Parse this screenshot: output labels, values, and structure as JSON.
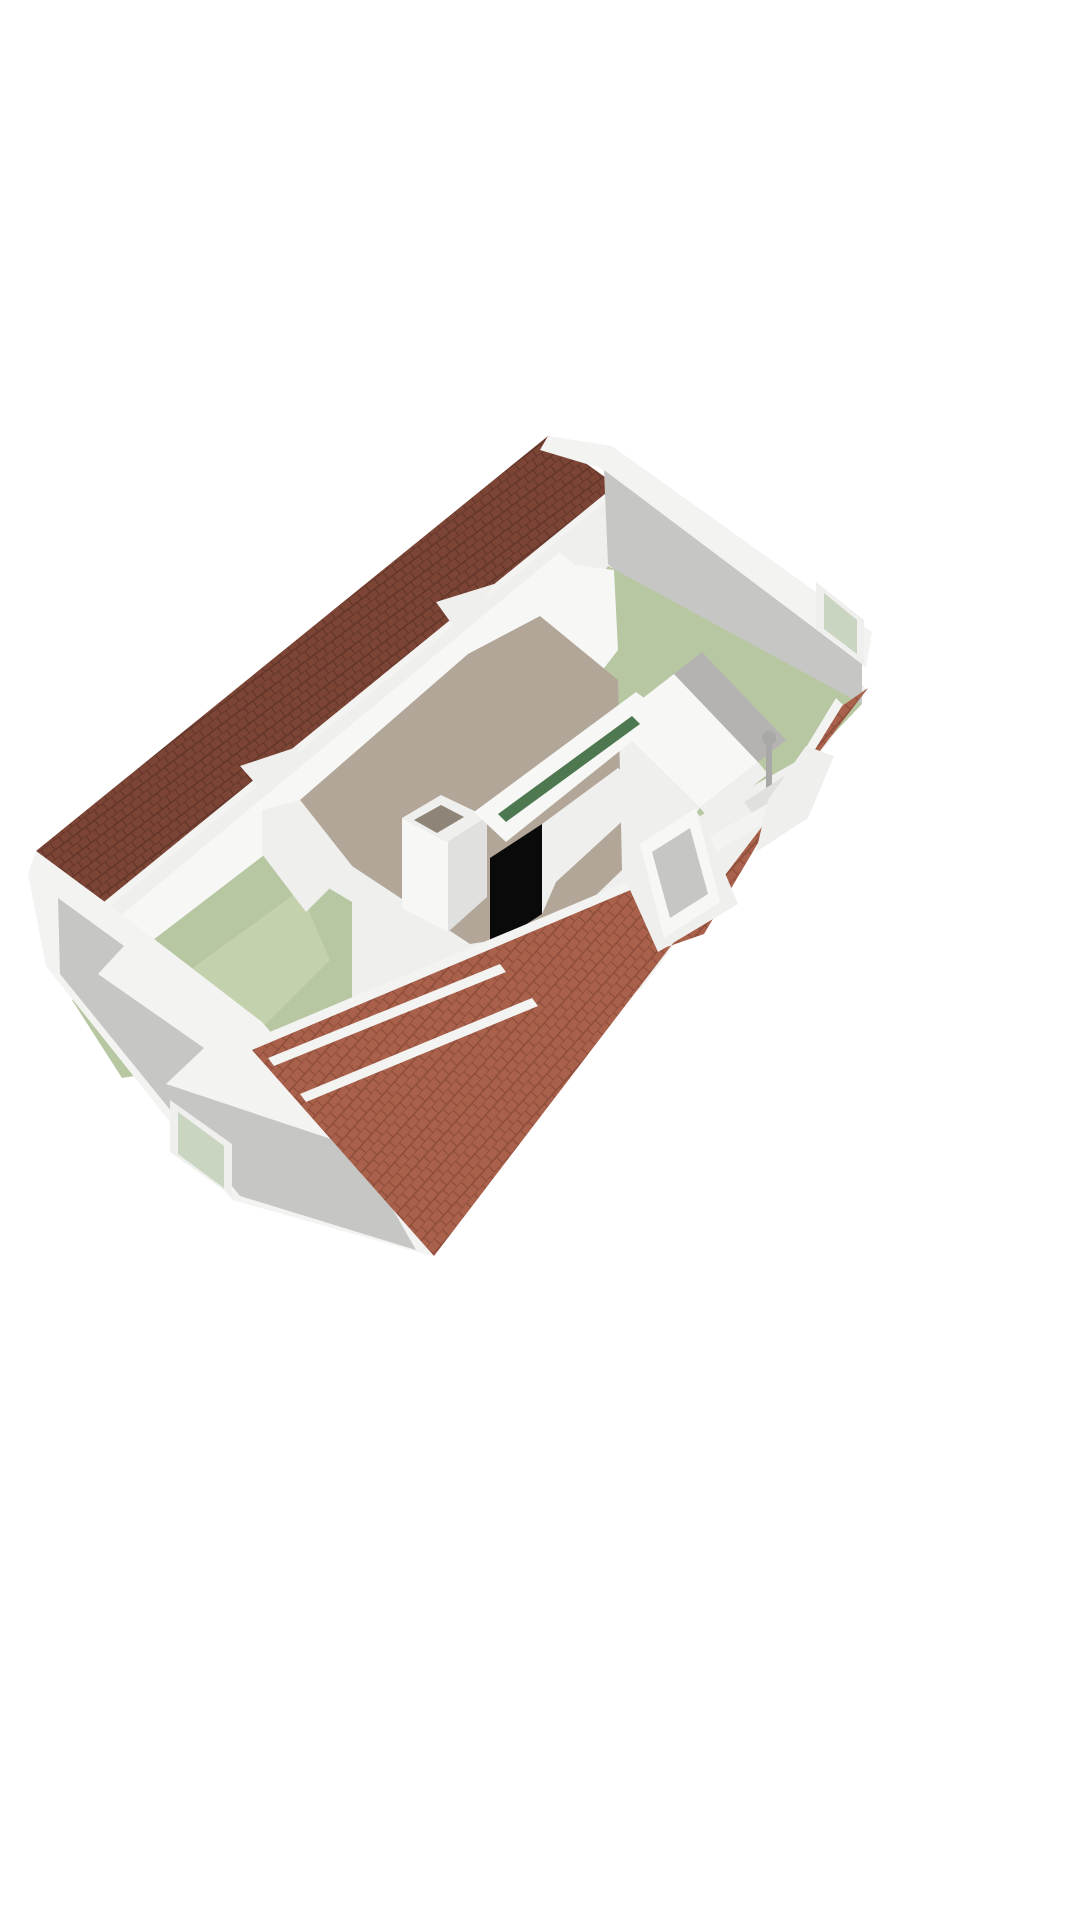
{
  "scene": {
    "kind": "3d-floorplan-cutaway-render",
    "view": "isometric-top",
    "background": "#ffffff",
    "colors": {
      "roof_dark_base": "#7c4434",
      "roof_dark_line": "#61352a",
      "roof_light_base": "#aa614b",
      "roof_light_line": "#8c4d3b",
      "roof_cut_white": "#f3f3f2",
      "wall_white": "#efefee",
      "wall_light": "#f7f7f6",
      "wall_shaded": "#e0e0df",
      "wall_gray": "#c6c6c5",
      "wall_gray_dark": "#b4b3b2",
      "floor_green": "#b7c7a1",
      "floor_green_light": "#c3d1ad",
      "floor_taupe": "#b2a698",
      "floor_taupe_dark": "#8e8478",
      "stair_void": "#0a0a0a",
      "handrail_green": "#4e7950",
      "glass_green": "#c9d5c0",
      "fixture_gray": "#a8a8a7"
    },
    "rooms": [
      {
        "id": "bedroom-upper-right",
        "floor": "floor_green"
      },
      {
        "id": "bedroom-lower-left",
        "floor": "floor_green"
      },
      {
        "id": "landing",
        "floor": "floor_taupe"
      },
      {
        "id": "bathroom",
        "floor": "wall_light"
      }
    ],
    "fixtures": [
      "chimney",
      "stair-opening",
      "stair-handrail",
      "door-frame",
      "shower-column",
      "gable-window-ne",
      "gable-window-sw"
    ]
  }
}
